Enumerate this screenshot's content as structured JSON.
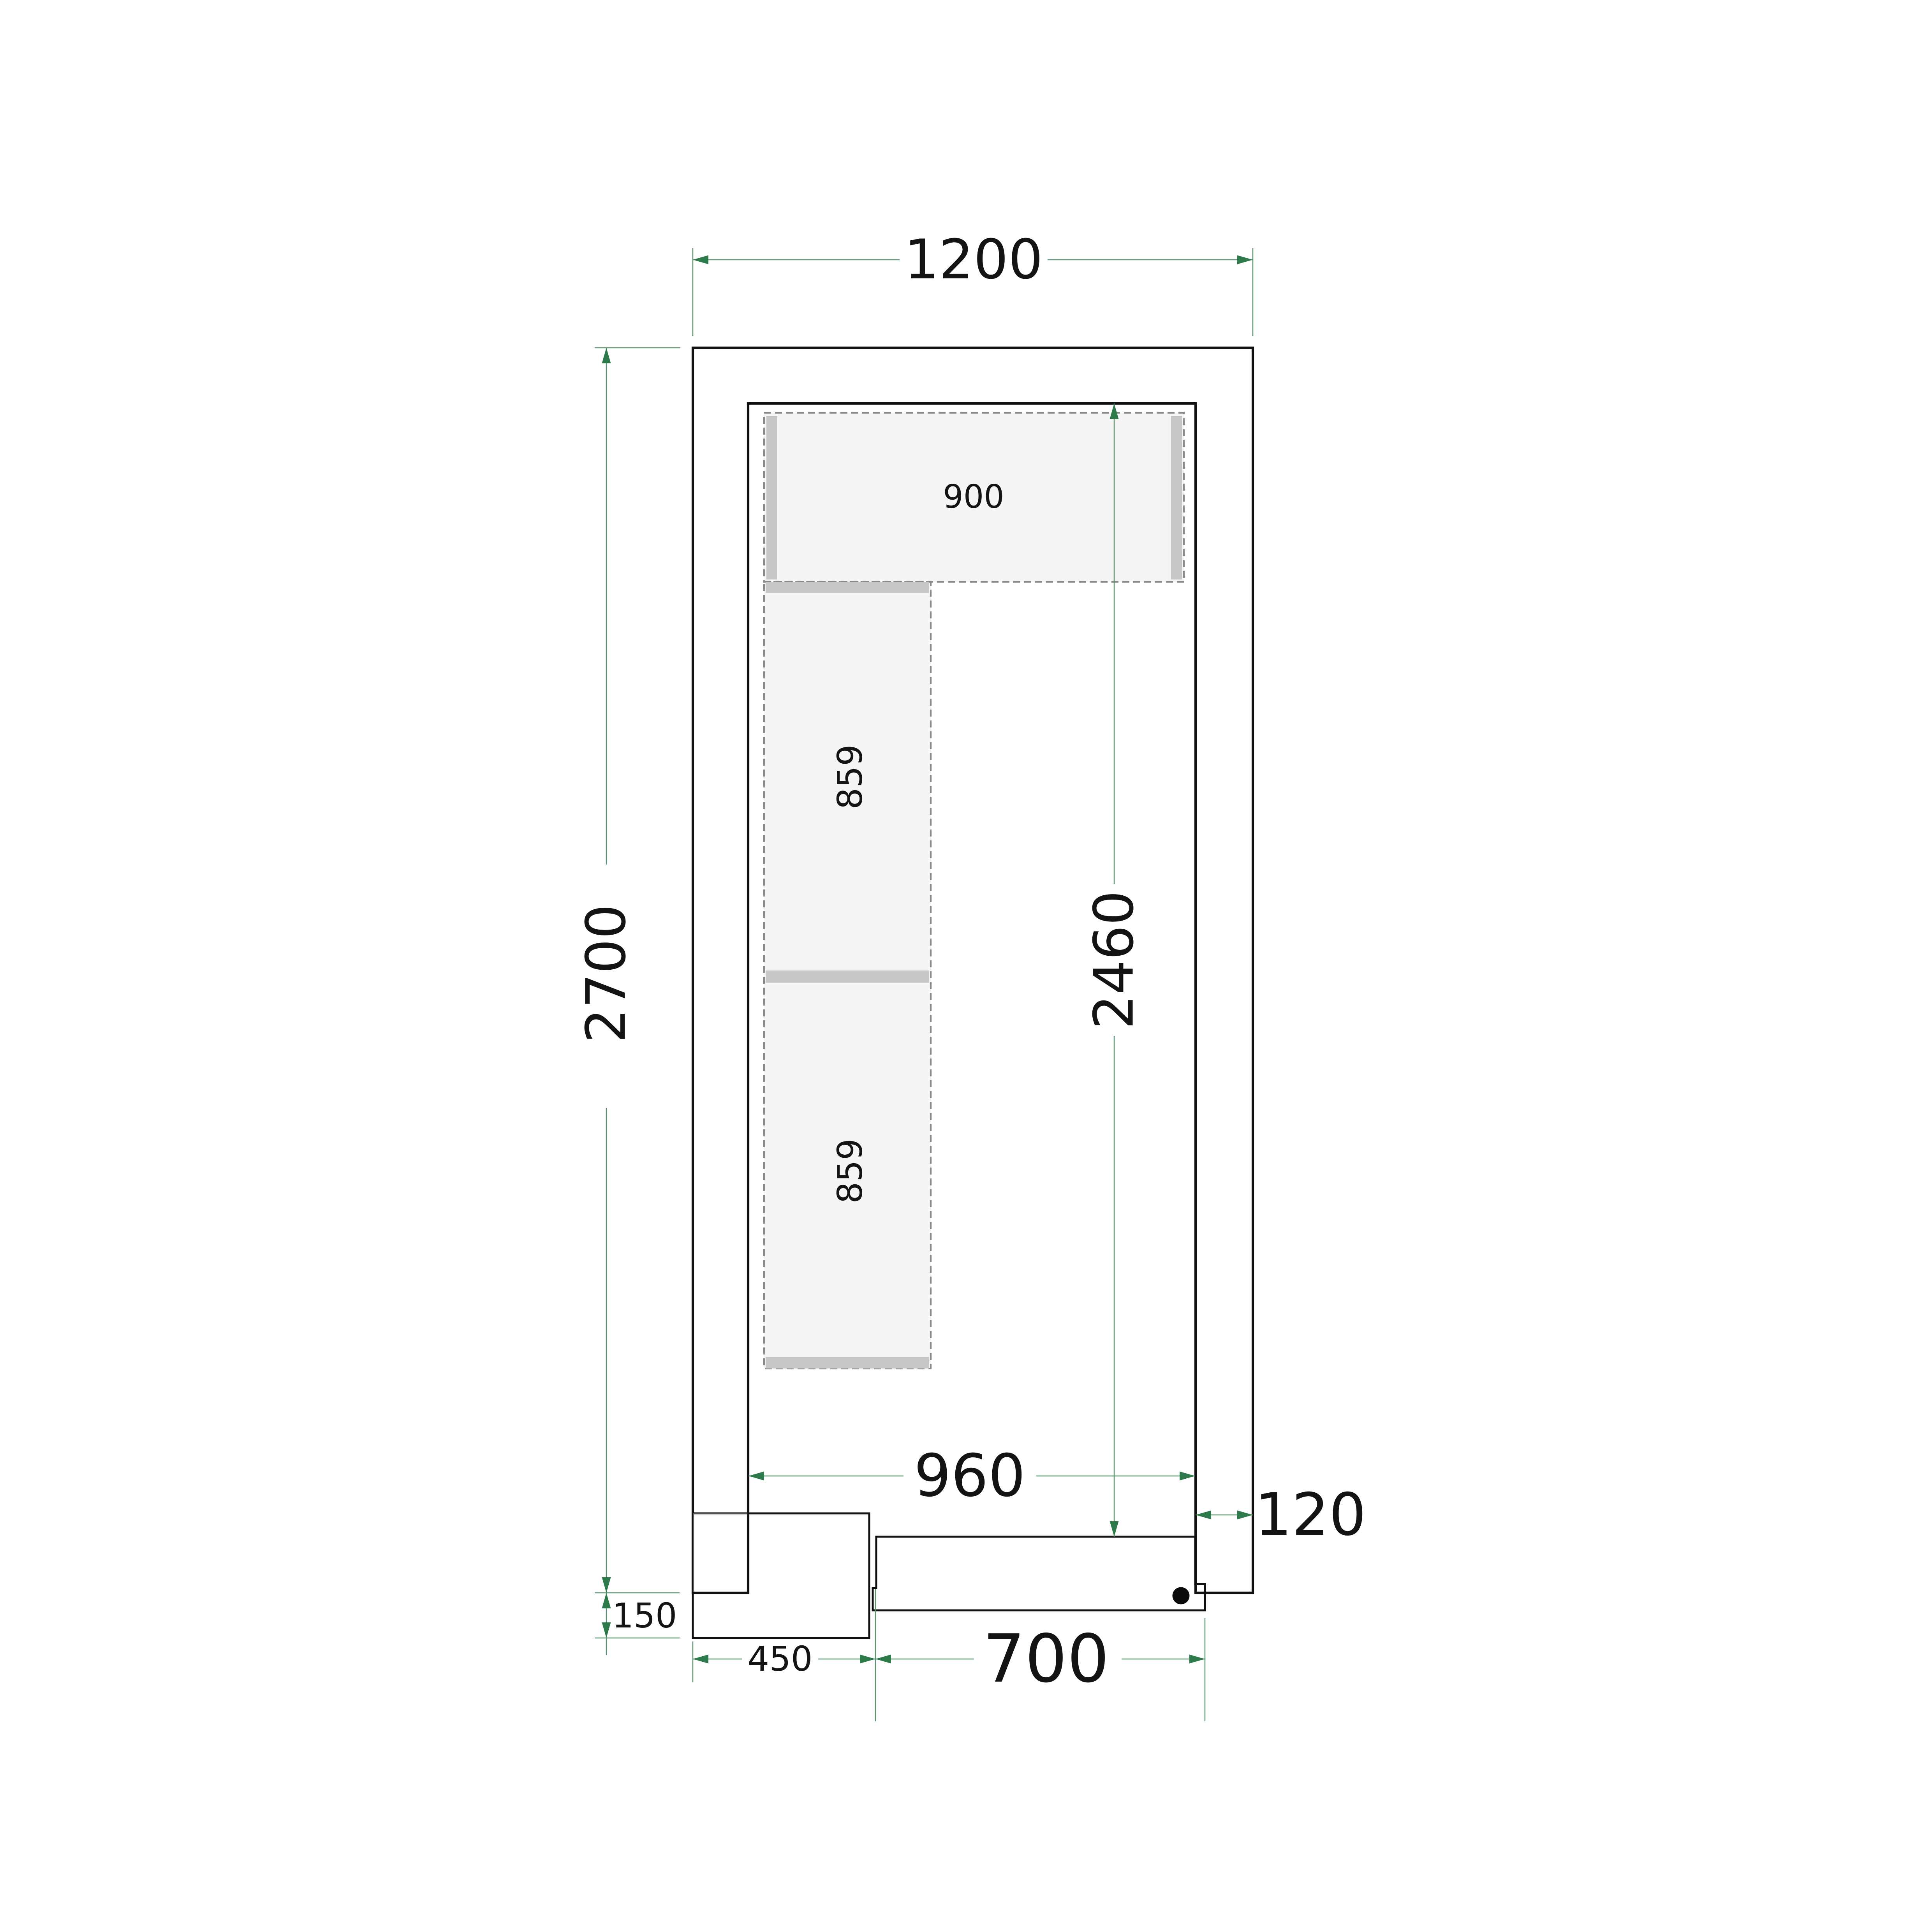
{
  "figure": {
    "kind": "cold-room floor plan technical drawing",
    "units": "mm"
  },
  "dims": {
    "outer_width": {
      "label": "1200"
    },
    "outer_depth": {
      "label": "2700"
    },
    "inner_width": {
      "label": "960"
    },
    "inner_depth": {
      "label": "2460"
    },
    "wall_thickness": {
      "label": "120"
    },
    "door_width": {
      "label": "700"
    },
    "unit_width": {
      "label": "450"
    },
    "unit_overhang": {
      "label": "150"
    }
  },
  "shelves": {
    "top_shelf": {
      "label": "900"
    },
    "left_shelf_upper": {
      "label": "859"
    },
    "left_shelf_lower": {
      "label": "859"
    }
  },
  "colors": {
    "wall_fill": "#e9e9e9",
    "interior_fill": "#ffffff",
    "shelf_fill": "#f5f5f5",
    "shelf_support_fill": "#c7c7c7",
    "door_leaf_fill": "#e3e3e3",
    "outline": "#111111",
    "dimension_line": "#5b9472",
    "dimension_arrow": "#2d7b4b",
    "unit_gradient_top": "#c6c7c3",
    "unit_gradient_mid1": "#c39a92",
    "unit_gradient_mid2": "#cf6a56",
    "unit_gradient_bottom": "#d7492f",
    "wall_overlap_veil": "rgba(255,255,255,0.32)",
    "handle_dot": "#0a0a0a"
  }
}
